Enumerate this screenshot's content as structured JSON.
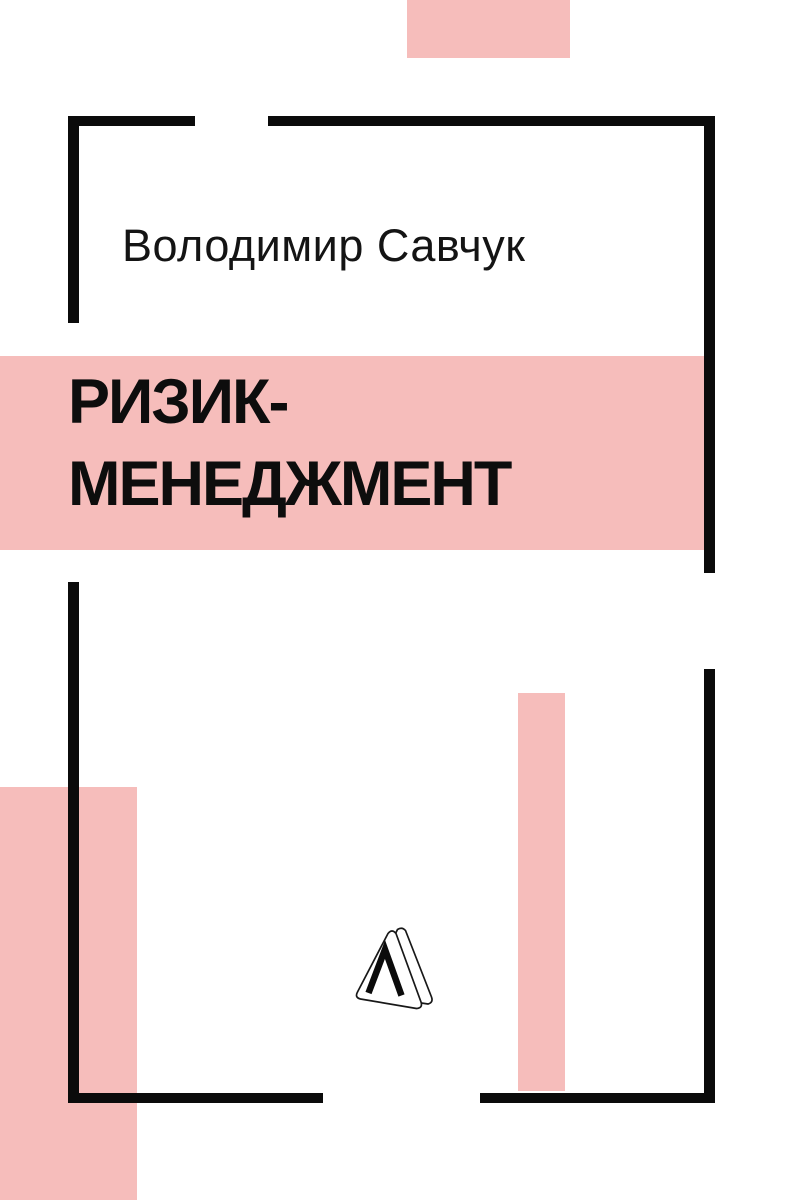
{
  "cover": {
    "author": "Володимир Савчук",
    "title": {
      "line1": "РИЗИК-",
      "line2": "МЕНЕДЖМЕНТ"
    },
    "publisher_logo": "triangle-prism-lambda-logo",
    "colors": {
      "background": "#ffffff",
      "accent_pink": "#f6bdbb",
      "frame_black": "#0b0b0b",
      "text_black": "#0d0d0d"
    }
  }
}
